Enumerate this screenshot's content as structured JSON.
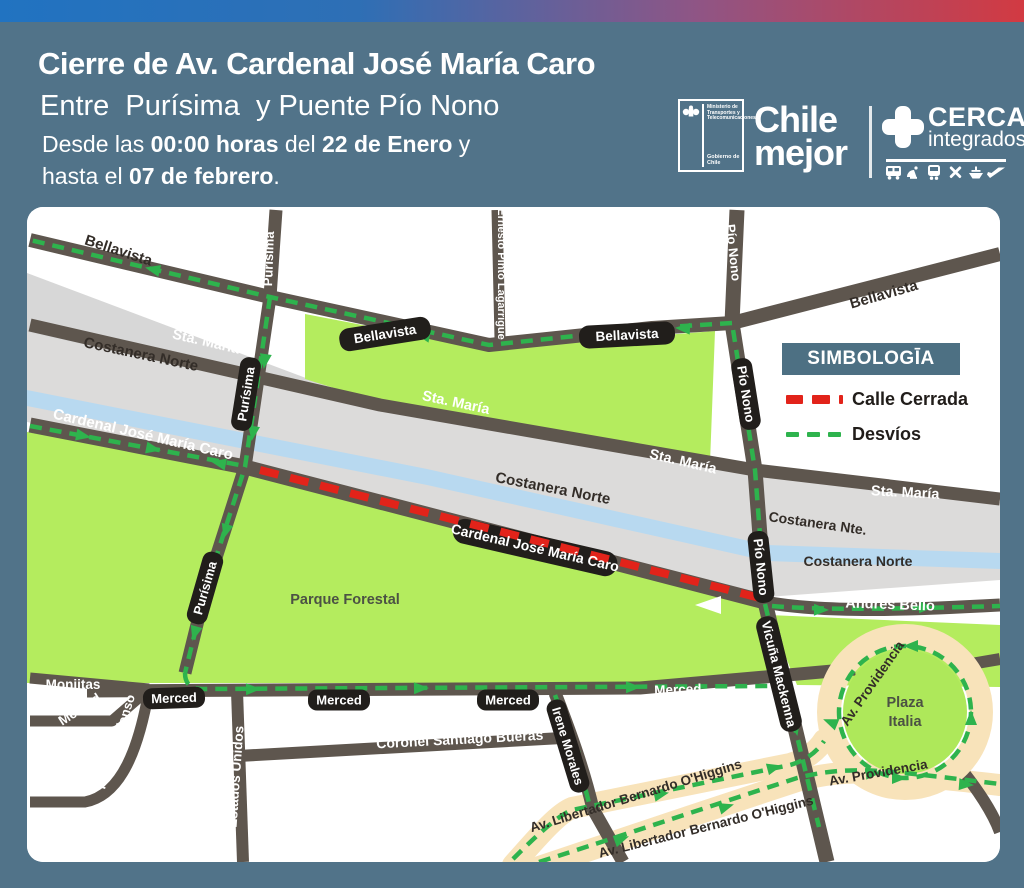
{
  "header": {
    "title": "Cierre de Av. Cardenal José María Caro",
    "subtitle": "Entre  Purísima  y Puente Pío Nono",
    "desde_prefix": "Desde las ",
    "desde_bold1": "00:00 horas",
    "desde_mid": " del ",
    "desde_bold2": "22 de Enero",
    "desde_suffix": " y",
    "hasta_prefix": "hasta el ",
    "hasta_bold": "07 de febrero",
    "hasta_suffix": "."
  },
  "logos": {
    "ministry_text": "Ministerio de Transportes y Telecomunicaciones",
    "ministry_footer": "Gobierno de Chile",
    "chile_line1": "Chile",
    "chile_line2": "mejor",
    "cerca_title": "CERCA",
    "cerca_subtitle": "integrados",
    "transport_icons": [
      "bus-icon",
      "satellite-icon",
      "train-icon",
      "tools-icon",
      "ship-icon",
      "plane-icon"
    ]
  },
  "legend": {
    "title": "SIMBOLOGĪA",
    "closed_label": "Calle Cerrada",
    "detour_label": "Desvíos"
  },
  "map": {
    "street_labels": {
      "bellavista": "Bellavista",
      "purisima": "Purísima",
      "ernesto_pinto": "Ernesto Pinto Lagarrigue",
      "pio_nono": "Pío Nono",
      "sta_maria": "Sta. María",
      "costanera_norte": "Costanera Norte",
      "costanera_nte": "Costanera Nte.",
      "cardenal_caro": "Cardenal José María Caro",
      "andres_bello": "Andrés Bello",
      "merced": "Merced",
      "monjitas": "Monjitas",
      "paulino_alfonso": "Paulino Alfonso",
      "estados_unidos": "Estados Unidos",
      "coronel_bueras": "Coronel Santiago Bueras",
      "irene_morales": "Irene Morales",
      "vicuna_mackenna": "Vicuña Mackenna",
      "ohiggins": "Av. Libertador Bernardo O'Higgins",
      "providencia": "Av. Providencia"
    },
    "areas": {
      "parque_forestal": "Parque Forestal",
      "plaza_line1": "Plaza",
      "plaza_line2": "Italia"
    }
  },
  "colors": {
    "closed_red": "#e2231a",
    "detour_green": "#2eb34d",
    "panel_teal": "#517389",
    "legend_teal": "#4d7083",
    "park_green": "#b4ec5e",
    "road_gray": "#5e564e",
    "river_blue": "#b8d9f0",
    "alameda_tan": "#f8e3ba",
    "gradient_left_blue": "#2173c1",
    "gradient_right_red": "#d23a42"
  }
}
